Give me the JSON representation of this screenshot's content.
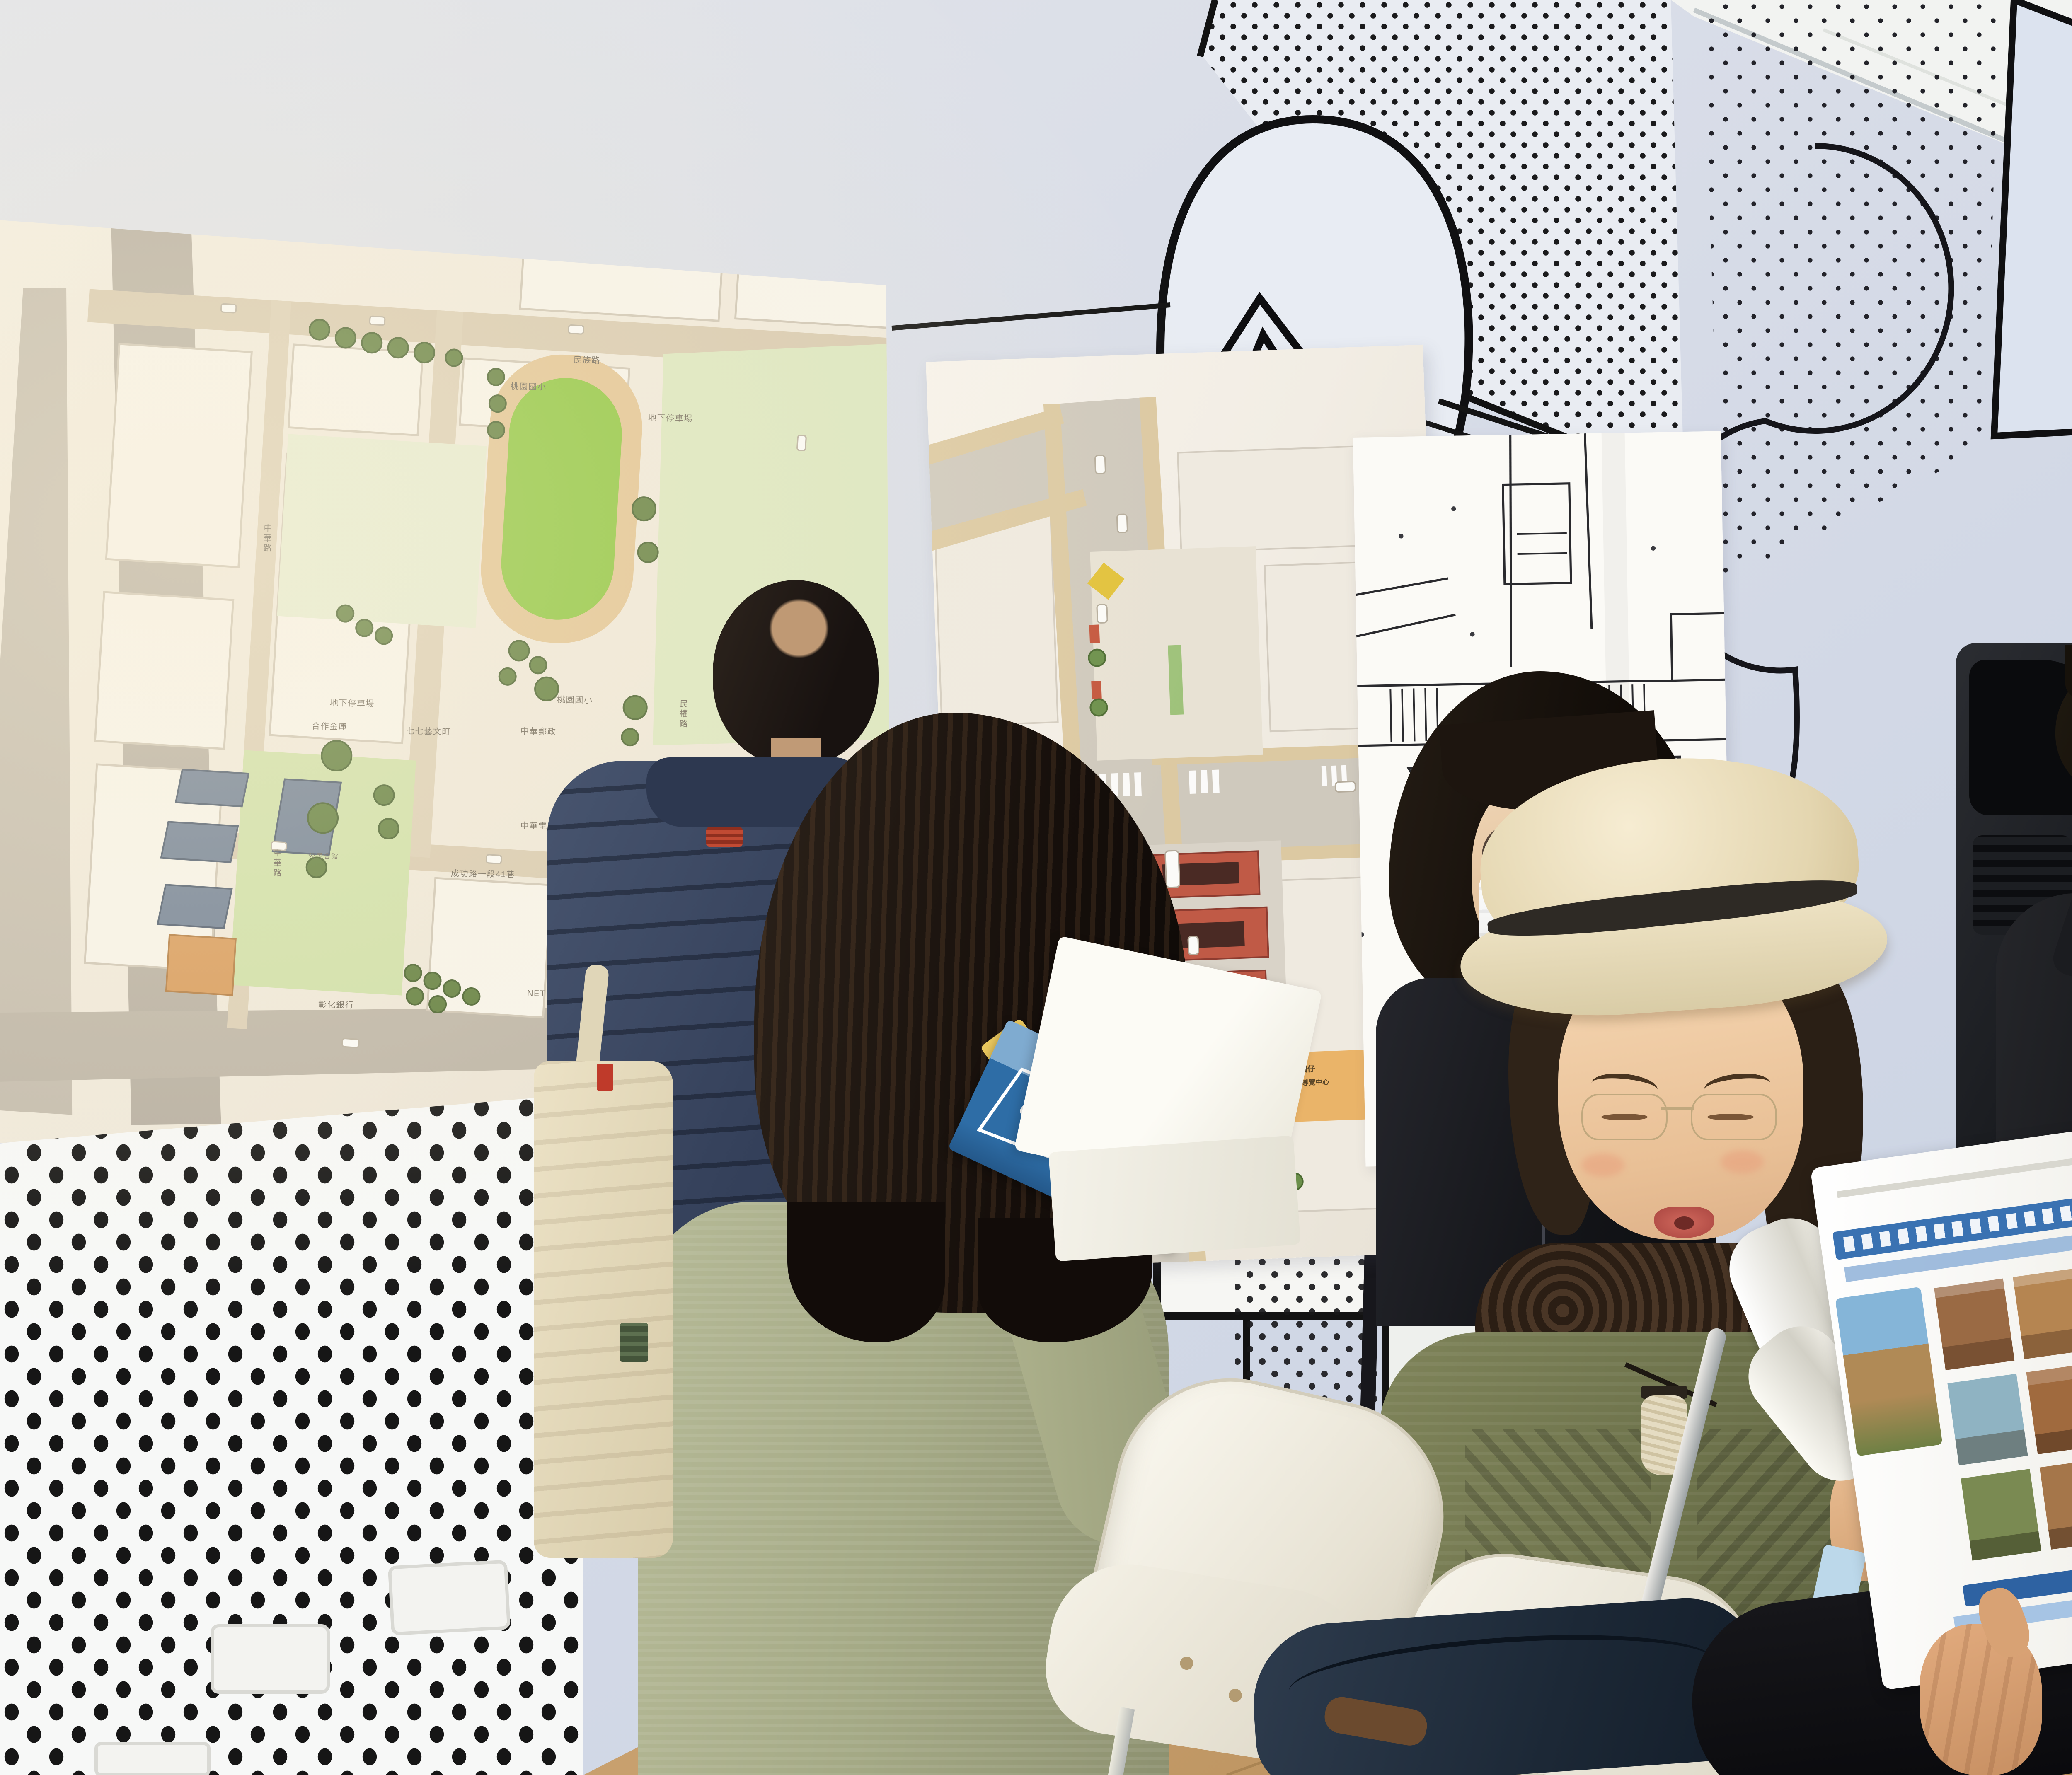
{
  "scene": {
    "description": "Visitors studying urban planning maps at a community exhibition wall decorated with comic-style speech bubbles and halftone dots"
  },
  "colors": {
    "wall": "#d6dbe7",
    "ceiling": "#f4f4f2",
    "park_green": "#8ec63f",
    "road_tan": "#d8cab0",
    "temple_red": "#c05a46",
    "fountain_blue": "#5b9fd4",
    "pamphlet_blue": "#2e6da6",
    "magazine_blue": "#3a72b2",
    "pegboard_dot": "#141414"
  },
  "maps": {
    "left": {
      "name": "site-plan-map",
      "labels": [
        {
          "text": "民族路"
        },
        {
          "text": "中華路"
        },
        {
          "text": "中華路"
        },
        {
          "text": "民權路"
        },
        {
          "text": "中正路"
        },
        {
          "text": "中正路"
        },
        {
          "text": "成功路一段41巷"
        },
        {
          "text": "成功路"
        },
        {
          "text": "桃園國小"
        },
        {
          "text": "桃園國小"
        },
        {
          "text": "地下停車場"
        },
        {
          "text": "地下停車場"
        },
        {
          "text": "合作金庫"
        },
        {
          "text": "七七藝文町"
        },
        {
          "text": "中華郵政"
        },
        {
          "text": "中華電信"
        },
        {
          "text": "彰化銀行"
        },
        {
          "text": "LOUISA COFFEE"
        },
        {
          "text": "NET"
        },
        {
          "text": "公民會館"
        }
      ]
    },
    "middle": {
      "name": "street-plan-map",
      "labels": [
        {
          "text": "桃園仔"
        },
        {
          "text": "舊城導覽中心"
        }
      ]
    },
    "right": {
      "name": "engineering-plan-map",
      "labels": []
    }
  },
  "pamphlet": {
    "title": "OYUAN"
  }
}
